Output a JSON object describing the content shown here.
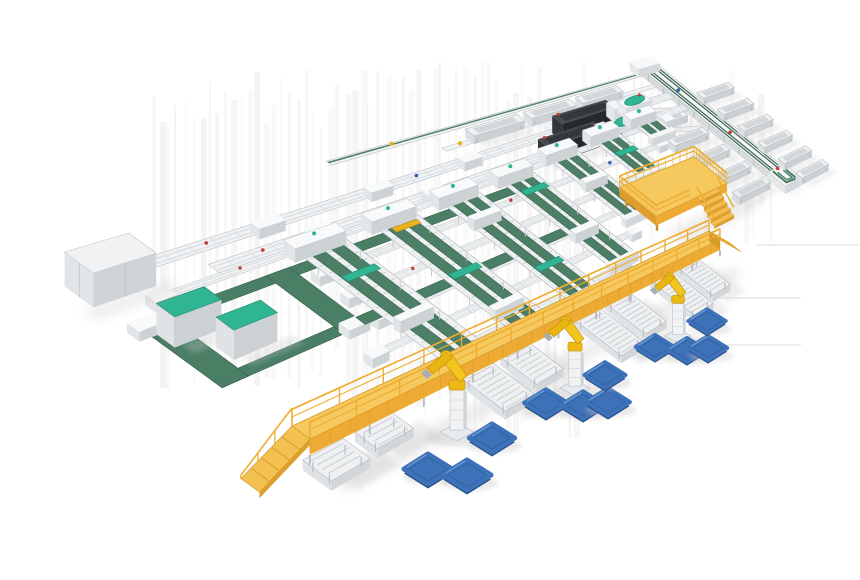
{
  "scene": {
    "width": 860,
    "height": 580,
    "kind": "isometric-3d-render-of-automated-conveyor-sorting-line",
    "palette": {
      "frame": "#f1f3f4",
      "frameEdge": "#c2c7cb",
      "frameShade": "#d7dbdd",
      "frameDark": "#b9bfc3",
      "belt": "#4c7f66",
      "beltDark": "#36604c",
      "flat": "#4a7f66",
      "teal": "#2fb593",
      "tealDark": "#1f8e73",
      "machineTop": "#464b51",
      "machineSide": "#33373b",
      "machineFront": "#26292c",
      "machineInset": "#383d42",
      "yellowTop": "#f6c95f",
      "yellowFace": "#edaa35",
      "yellowDark": "#d89c28",
      "yellowRail": "#eead31",
      "rampTop": "#f3c052",
      "robotYellow": "#f3c51d",
      "robotYellow2": "#e8b512",
      "robotEdge": "#c6950a",
      "palletTop": "#3e72b8",
      "palletSide": "#27508d",
      "palletLine": "#2f5d9e",
      "palletHi": "#719fd4",
      "shadow": "#c9c9c9",
      "streak": "#e2e2e2",
      "red": "#c23b33",
      "blue": "#2d5faa",
      "yellowMark": "#eab31e"
    },
    "background": {
      "streaks": {
        "count": 78,
        "x0": 150,
        "x1": 772
      },
      "hlines": [
        [
          700,
          298,
          801,
          298
        ],
        [
          718,
          345,
          801,
          345
        ],
        [
          757,
          245,
          858,
          245
        ]
      ]
    },
    "topRail": {
      "v": -0.17,
      "u0": 0.34,
      "u1": 1.03,
      "marks": [
        {
          "u": 0.44,
          "c": "yellowMark"
        }
      ]
    },
    "trayRow": {
      "v": -0.115,
      "u0": 0.5,
      "u1": 1.01,
      "trays": [
        0.56,
        0.68,
        0.8
      ],
      "marks": [
        {
          "u": 0.53,
          "c": "yellowMark"
        }
      ]
    },
    "feeds": [
      {
        "v": 0.02,
        "u0": 0.055,
        "u1": 1.0,
        "machine": {
          "u0": 0.7,
          "u1": 0.83
        },
        "head": {
          "u0": 0.86,
          "u1": 0.93
        },
        "boxes": [
          0.18,
          0.34,
          0.5
        ],
        "marks": [
          {
            "u": 0.12,
            "c": "red"
          },
          {
            "u": 0.42,
            "c": "blue"
          }
        ]
      },
      {
        "v": 0.13,
        "u0": 0.1,
        "u1": 1.0,
        "machine": {
          "u0": 0.63,
          "u1": 0.76
        },
        "head": {
          "u0": 0.79,
          "u1": 0.86
        },
        "boxes": [
          0.22,
          0.4
        ],
        "marks": [
          {
            "u": 0.16,
            "c": "red"
          },
          {
            "u": 0.48,
            "c": "blue"
          }
        ]
      }
    ],
    "rails": [
      {
        "v": 0.18,
        "u0": 0.03,
        "u1": 0.93,
        "marks": [
          {
            "u": 0.12,
            "c": "red"
          },
          {
            "u": 0.3,
            "c": "red"
          },
          {
            "u": 0.55,
            "c": "blue"
          },
          {
            "u": 0.8,
            "c": "red"
          }
        ]
      },
      {
        "v": 0.32,
        "u0": 0.19,
        "u1": 0.855,
        "marks": [
          {
            "u": 0.25,
            "c": "blue"
          },
          {
            "u": 0.5,
            "c": "red"
          },
          {
            "u": 0.72,
            "c": "blue"
          }
        ]
      },
      {
        "v": 0.46,
        "u0": 0.19,
        "u1": 0.777,
        "marks": [
          {
            "u": 0.28,
            "c": "red"
          },
          {
            "u": 0.55,
            "c": "blue"
          }
        ]
      },
      {
        "v": 0.6,
        "u0": 0.19,
        "u1": 0.7,
        "marks": [
          {
            "u": 0.3,
            "c": "red"
          },
          {
            "u": 0.52,
            "c": "red"
          }
        ]
      },
      {
        "v": 0.74,
        "u0": 0.14,
        "u1": 0.62,
        "marks": [
          {
            "u": 0.24,
            "c": "blue"
          },
          {
            "u": 0.45,
            "c": "red"
          }
        ]
      },
      {
        "v": 0.88,
        "u0": 0.18,
        "u1": 0.543,
        "marks": [
          {
            "u": 0.3,
            "c": "red"
          }
        ]
      }
    ],
    "flatBelts": [
      {
        "u0": 0.165,
        "u1": 0.52,
        "v0": 0.26,
        "v1": 0.305
      },
      {
        "u0": 0.165,
        "u1": 0.52,
        "v0": 0.575,
        "v1": 0.62
      }
    ],
    "loop": {
      "u0": -0.015,
      "u1": 0.165,
      "v0": 0.26,
      "v1": 0.62,
      "bu": 0.03,
      "bv": 0.045,
      "cabinets": [
        {
          "u0": -0.002,
          "v0": 0.3,
          "u1": 0.05,
          "v1": 0.375
        },
        {
          "u0": 0.028,
          "v0": 0.435,
          "u1": 0.08,
          "v1": 0.51
        }
      ]
    },
    "leftMachine": {
      "u0": -0.02,
      "u1": 0.045,
      "v0": 0.0,
      "v1": 0.115,
      "h": 34
    },
    "lanes": [
      {
        "u": 0.22,
        "v0": 0.19,
        "v1": 0.93,
        "accents": [
          {
            "v": 0.4,
            "t": "teal"
          },
          {
            "v": 0.66,
            "t": "box"
          }
        ]
      },
      {
        "u": 0.33,
        "v0": 0.19,
        "v1": 0.93,
        "accents": [
          {
            "v": 0.27,
            "t": "yellow"
          },
          {
            "v": 0.58,
            "t": "teal"
          },
          {
            "v": 0.8,
            "t": "box"
          }
        ]
      },
      {
        "u": 0.44,
        "v0": 0.19,
        "v1": 0.93,
        "accents": [
          {
            "v": 0.35,
            "t": "box"
          },
          {
            "v": 0.72,
            "t": "teal"
          }
        ]
      },
      {
        "u": 0.55,
        "v0": 0.19,
        "v1": 0.865,
        "accents": [
          {
            "v": 0.32,
            "t": "teal"
          },
          {
            "v": 0.62,
            "t": "box"
          }
        ]
      },
      {
        "u": 0.66,
        "v0": 0.16,
        "v1": 0.67,
        "accents": [
          {
            "v": 0.38,
            "t": "box"
          }
        ]
      },
      {
        "u": 0.77,
        "v0": 0.14,
        "v1": 0.47,
        "accents": [
          {
            "v": 0.3,
            "t": "teal"
          }
        ]
      },
      {
        "u": 0.88,
        "v0": 0.12,
        "v1": 0.275,
        "accents": []
      }
    ],
    "trunk": {
      "u0": 1.0,
      "u1": 1.048,
      "v0": -0.19,
      "v1": 0.93,
      "traysLeft": {
        "u0": 0.872,
        "v": [
          0.18,
          0.34,
          0.5,
          0.66,
          0.81
        ]
      },
      "traysRight": {
        "u0": 1.058,
        "v": [
          0.1,
          0.26,
          0.42,
          0.58,
          0.74,
          0.88
        ]
      },
      "endUnit": {
        "u0": 0.995,
        "u1": 1.055,
        "v0": 0.8,
        "v1": 0.935
      },
      "connectors": [
        [
          [
            0.92,
            0.085
          ],
          [
            0.998,
            0.16
          ],
          [
            0.998,
            0.2
          ],
          [
            0.92,
            0.125
          ]
        ],
        [
          [
            0.85,
            0.195
          ],
          [
            0.998,
            0.33
          ],
          [
            0.998,
            0.37
          ],
          [
            0.85,
            0.235
          ]
        ]
      ]
    },
    "platform": {
      "u0": 0.66,
      "u1": 0.86,
      "v0": 0.56,
      "v1": 0.8,
      "h": 28,
      "railH": 17,
      "stairs": {
        "u0": 0.77,
        "u1": 0.83,
        "v0": 0.8,
        "steps": 5
      }
    },
    "walkway": {
      "uA": -0.02,
      "uB": 0.72,
      "vA": 0.93,
      "vB": 1.005,
      "w": 0.075,
      "h": 26,
      "railH": 17,
      "posts": 13,
      "legs": 10,
      "rampDu": 0.058
    },
    "discharge": [
      {
        "u": -0.005,
        "v0": 1.01,
        "v1": 1.13
      },
      {
        "u": 0.06,
        "v0": 1.01,
        "v1": 1.11
      },
      {
        "u": 0.21,
        "v0": 1.02,
        "v1": 1.24
      },
      {
        "u": 0.275,
        "v0": 1.02,
        "v1": 1.21
      },
      {
        "u": 0.41,
        "v0": 1.03,
        "v1": 1.3
      },
      {
        "u": 0.475,
        "v0": 1.03,
        "v1": 1.27
      },
      {
        "u": 0.575,
        "v0": 1.04,
        "v1": 1.32
      },
      {
        "u": 0.64,
        "v0": 1.04,
        "v1": 1.28
      }
    ],
    "robots": [
      {
        "x": 457,
        "y": 432,
        "s": 1.0
      },
      {
        "x": 575,
        "y": 388,
        "s": 0.88
      },
      {
        "x": 678,
        "y": 336,
        "s": 0.78
      }
    ],
    "pallets": [
      {
        "x": 428,
        "y": 469,
        "s": 1.0
      },
      {
        "x": 467,
        "y": 475,
        "s": 1.0
      },
      {
        "x": 492,
        "y": 438,
        "s": 0.95
      },
      {
        "x": 546,
        "y": 403,
        "s": 0.9
      },
      {
        "x": 583,
        "y": 405,
        "s": 0.9
      },
      {
        "x": 608,
        "y": 402,
        "s": 0.9
      },
      {
        "x": 605,
        "y": 375,
        "s": 0.85
      },
      {
        "x": 655,
        "y": 347,
        "s": 0.8
      },
      {
        "x": 687,
        "y": 350,
        "s": 0.8
      },
      {
        "x": 708,
        "y": 348,
        "s": 0.8
      },
      {
        "x": 707,
        "y": 321,
        "s": 0.78
      }
    ]
  }
}
